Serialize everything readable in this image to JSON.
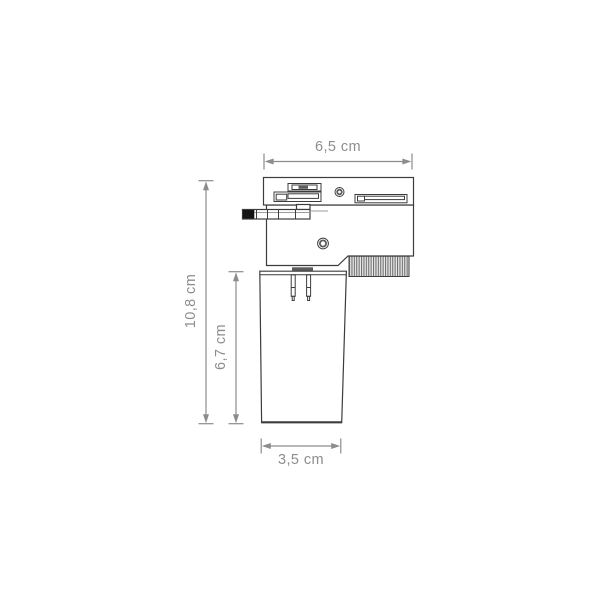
{
  "labels": {
    "width_top": "6,5 cm",
    "height_total": "10,8 cm",
    "height_lamp": "6,7 cm",
    "width_bottom": "3,5 cm"
  },
  "colors": {
    "background": "#ffffff",
    "outline": "#3c3c3c",
    "dim": "#8c8c8c",
    "text": "#8d8d8d",
    "tip": "#141414",
    "connector": "#5c5c5c",
    "ribs_bg": "#ebebeb",
    "ribs_line": "#6e6e6e"
  }
}
